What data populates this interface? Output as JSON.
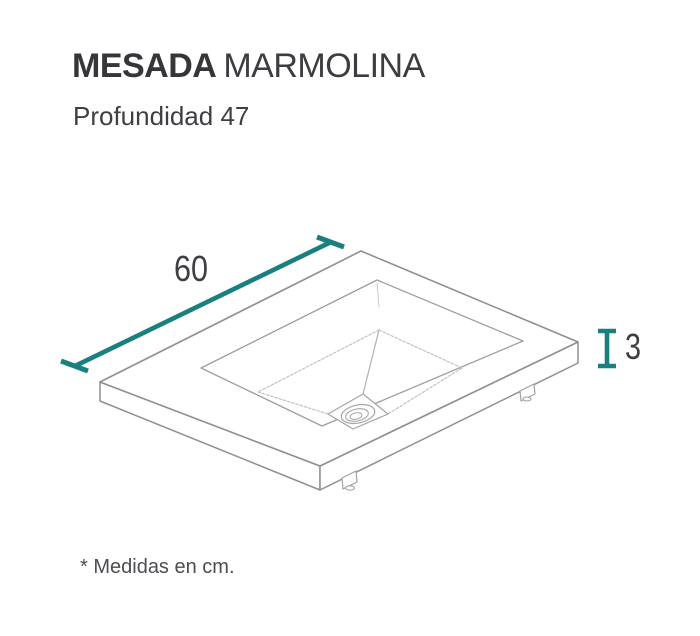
{
  "header": {
    "title_bold": "MESADA",
    "title_regular": "MARMOLINA",
    "subtitle": "Profundidad 47"
  },
  "diagram": {
    "type": "isometric-line-drawing",
    "subject": "vanity countertop with integrated sink and drain",
    "dimensions": {
      "width_cm": "60",
      "thickness_cm": "3",
      "depth_cm": "47"
    },
    "accent_color": "#1a7f7f",
    "outline_color": "#8f8f8f",
    "label_color": "#3f3f43"
  },
  "footer": {
    "note": "* Medidas en cm."
  }
}
